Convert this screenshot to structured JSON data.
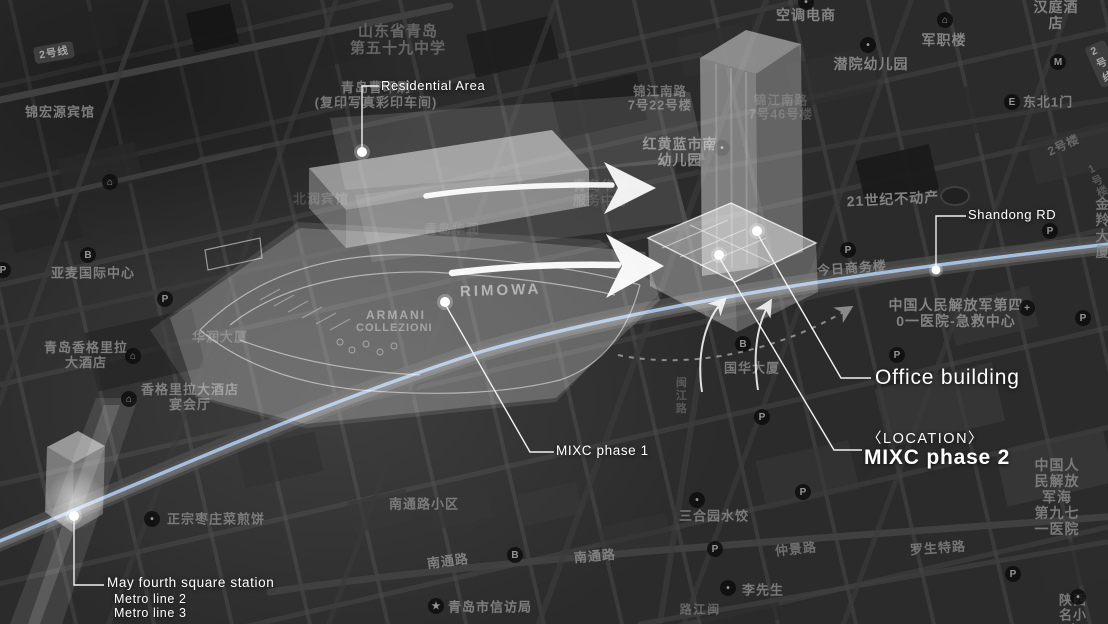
{
  "annotations": {
    "residential_area": "Residential Area",
    "shandong_rd": "Shandong RD",
    "office_building": "Office building",
    "location_tag": "〈LOCATION〉",
    "mixc_phase_2": "MIXC phase 2",
    "mixc_phase_1": "MIXC phase 1",
    "station": "May fourth square station",
    "metro_line_2": "Metro line 2",
    "metro_line_3": "Metro line 3"
  },
  "site_plan_texts": {
    "brand_1": "RIMOWA",
    "brand_2_line1": "ARMANI",
    "brand_2_line2": "COLLEZIONI"
  },
  "map": {
    "metro_badges": [
      {
        "text": "2号线",
        "x": 34,
        "y": 44,
        "rot": -10
      },
      {
        "text": "2号线",
        "x": 1092,
        "y": 42,
        "rot": -24
      }
    ],
    "labels": [
      {
        "text": "山东省青岛\n第五十九中学",
        "x": 398,
        "y": 40,
        "fs": 15,
        "op": 0.8,
        "color": "#757575"
      },
      {
        "text": "空调电商",
        "x": 806,
        "y": 15,
        "fs": 14,
        "op": 0.9
      },
      {
        "text": "军职楼",
        "x": 944,
        "y": 40,
        "fs": 14,
        "op": 0.9
      },
      {
        "text": "汉庭酒店",
        "x": 1056,
        "y": 15,
        "fs": 14,
        "op": 0.9
      },
      {
        "text": "潜院幼儿园",
        "x": 871,
        "y": 64,
        "fs": 14,
        "op": 0.9
      },
      {
        "text": "东北1门",
        "x": 1048,
        "y": 103,
        "fs": 13,
        "op": 0.85
      },
      {
        "text": "锦宏源宾馆",
        "x": 60,
        "y": 113,
        "fs": 13,
        "op": 0.85
      },
      {
        "text": "青岛曹印刷\n(复印写真彩印车间)",
        "x": 376,
        "y": 96,
        "fs": 13,
        "op": 0.8
      },
      {
        "text": "锦江南路\n7号22号楼",
        "x": 660,
        "y": 99,
        "fs": 12.5,
        "op": 0.75
      },
      {
        "text": "锦江南路\n7号46号楼",
        "x": 781,
        "y": 108,
        "fs": 12.5,
        "op": 0.4
      },
      {
        "text": "红黄蓝市南\n幼儿园",
        "x": 680,
        "y": 152,
        "fs": 14,
        "op": 0.95
      },
      {
        "text": "21世纪不动产",
        "x": 893,
        "y": 199,
        "fs": 14,
        "op": 0.9,
        "rot": -3
      },
      {
        "text": "2号楼",
        "x": 1064,
        "y": 146,
        "fs": 12,
        "op": 0.6,
        "rot": -25
      },
      {
        "text": "1号楼",
        "x": 1098,
        "y": 181,
        "fs": 11,
        "op": 0.45,
        "rot": -25
      },
      {
        "text": "金羚大厦",
        "x": 1103,
        "y": 228,
        "fs": 14,
        "op": 0.75
      },
      {
        "text": "今日商务楼",
        "x": 852,
        "y": 269,
        "fs": 13,
        "op": 0.85,
        "rot": -4
      },
      {
        "text": "中国人民解放军第四\n0一医院-急救中心",
        "x": 956,
        "y": 313,
        "fs": 14,
        "op": 0.9
      },
      {
        "text": "亚麦国际中心",
        "x": 93,
        "y": 274,
        "fs": 13,
        "op": 0.85
      },
      {
        "text": "华润大厦",
        "x": 220,
        "y": 338,
        "fs": 13,
        "op": 0.55
      },
      {
        "text": "青岛香格里拉\n大酒店",
        "x": 86,
        "y": 356,
        "fs": 13,
        "op": 0.85
      },
      {
        "text": "香格里拉大酒店\n宴会厅",
        "x": 190,
        "y": 398,
        "fs": 13,
        "op": 0.85
      },
      {
        "text": "国华大厦",
        "x": 752,
        "y": 369,
        "fs": 13,
        "op": 0.8
      },
      {
        "text": "正宗枣庄菜煎饼",
        "x": 216,
        "y": 520,
        "fs": 13,
        "op": 0.8
      },
      {
        "text": "南通路小区",
        "x": 424,
        "y": 505,
        "fs": 13,
        "op": 0.8
      },
      {
        "text": "南通路",
        "x": 448,
        "y": 562,
        "fs": 13,
        "op": 0.85,
        "rot": -7
      },
      {
        "text": "南通路",
        "x": 595,
        "y": 557,
        "fs": 13,
        "op": 0.85,
        "rot": -5
      },
      {
        "text": "青岛市信访局",
        "x": 490,
        "y": 608,
        "fs": 13,
        "op": 0.85
      },
      {
        "text": "三合园水饺",
        "x": 714,
        "y": 517,
        "fs": 13,
        "op": 0.8
      },
      {
        "text": "仲景路",
        "x": 796,
        "y": 550,
        "fs": 13,
        "op": 0.7,
        "rot": -6
      },
      {
        "text": "罗生特路",
        "x": 938,
        "y": 549,
        "fs": 13,
        "op": 0.75,
        "rot": -4
      },
      {
        "text": "李先生",
        "x": 763,
        "y": 591,
        "fs": 13,
        "op": 0.8
      },
      {
        "text": "中国人民解放军海\n第九七一医院",
        "x": 1057,
        "y": 497,
        "fs": 14,
        "op": 0.8
      },
      {
        "text": "陕西名小吃",
        "x": 1073,
        "y": 616,
        "fs": 13,
        "op": 0.8
      },
      {
        "text": "闽江路",
        "x": 698,
        "y": 610,
        "fs": 12,
        "op": 0.6,
        "vertical": true
      },
      {
        "text": "闽江路",
        "x": 680,
        "y": 396,
        "fs": 11,
        "op": 0.45,
        "vertical": true
      },
      {
        "text": "青岛华润\n服务中心",
        "x": 601,
        "y": 194,
        "fs": 13,
        "op": 0.5,
        "color": "#6b6b6b"
      },
      {
        "text": "青岛华润",
        "x": 452,
        "y": 230,
        "fs": 13,
        "op": 0.4,
        "color": "#6b6b6b"
      },
      {
        "text": "北润宾馆",
        "x": 321,
        "y": 200,
        "fs": 13,
        "op": 0.7,
        "color": "#5f5f5f"
      }
    ],
    "icons": [
      {
        "g": "P",
        "x": 165,
        "y": 299
      },
      {
        "g": "P",
        "x": 848,
        "y": 250
      },
      {
        "g": "P",
        "x": 1050,
        "y": 231
      },
      {
        "g": "P",
        "x": 897,
        "y": 355
      },
      {
        "g": "P",
        "x": 762,
        "y": 417
      },
      {
        "g": "P",
        "x": 1083,
        "y": 318
      },
      {
        "g": "P",
        "x": 803,
        "y": 492
      },
      {
        "g": "P",
        "x": 715,
        "y": 549
      },
      {
        "g": "P",
        "x": 1013,
        "y": 574
      },
      {
        "g": "P",
        "x": 3,
        "y": 270
      },
      {
        "g": "+",
        "x": 1027,
        "y": 308
      },
      {
        "g": "★",
        "x": 436,
        "y": 606
      },
      {
        "g": "E",
        "x": 1012,
        "y": 102
      },
      {
        "g": "M",
        "x": 1058,
        "y": 62
      },
      {
        "g": "B",
        "x": 88,
        "y": 255
      },
      {
        "g": "B",
        "x": 743,
        "y": 344
      },
      {
        "g": "B",
        "x": 515,
        "y": 555
      },
      {
        "g": "⌂",
        "x": 110,
        "y": 182
      },
      {
        "g": "⌂",
        "x": 133,
        "y": 356
      },
      {
        "g": "⌂",
        "x": 129,
        "y": 399
      },
      {
        "g": "⌂",
        "x": 945,
        "y": 20
      },
      {
        "g": "•",
        "x": 152,
        "y": 519
      },
      {
        "g": "•",
        "x": 728,
        "y": 588
      },
      {
        "g": "•",
        "x": 1078,
        "y": 597
      },
      {
        "g": "•",
        "x": 697,
        "y": 500
      },
      {
        "g": "•",
        "x": 868,
        "y": 45
      },
      {
        "g": "•",
        "x": 806,
        "y": 2
      },
      {
        "g": "•",
        "x": 722,
        "y": 148
      }
    ]
  },
  "colors": {
    "background": "#2b2b2b",
    "road_blue": "#a9c4e8",
    "annotation_text": "#ffffff",
    "map_text": "#8d8d8d"
  }
}
